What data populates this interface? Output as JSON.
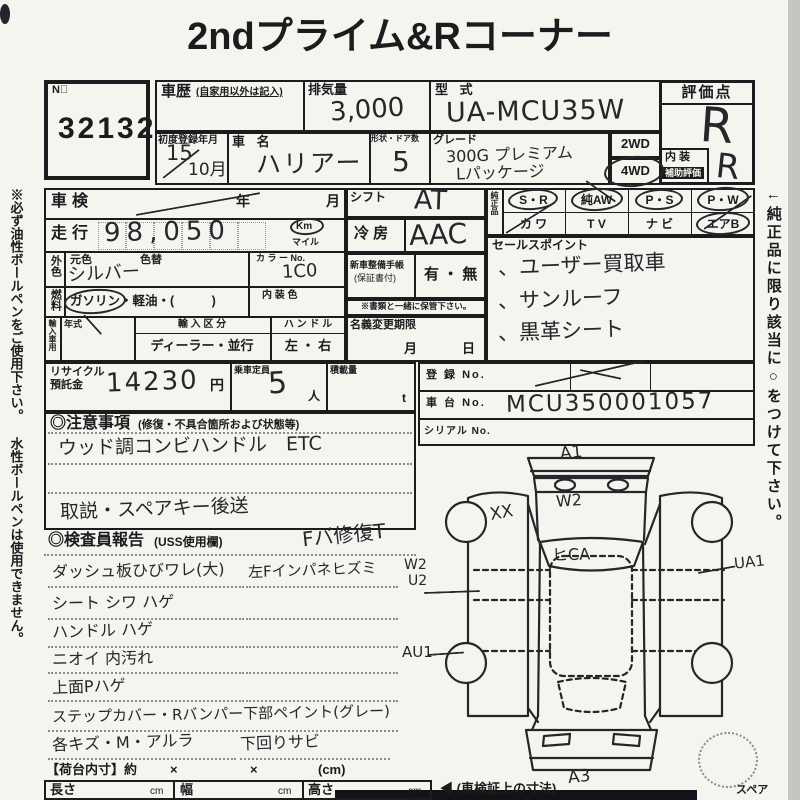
{
  "meta": {
    "paper_color": "#f5f4ef",
    "ink_color": "#1c1c1e",
    "handwriting_color": "#26262b"
  },
  "title": "2ndプライム&Rコーナー",
  "margins": {
    "left_note": "※必ず油性ボールペンをご使用下さい。 水性ボールペンは使用できません。",
    "right_note": "←純正品に限り該当に○をつけて下さい。"
  },
  "lot": {
    "label": "N゚",
    "number": "32132"
  },
  "header": {
    "shareki_label": "車歴",
    "shareki_note": "(自家用以外は記入)",
    "displacement_label": "排気量",
    "displacement": "3,000",
    "model_code_label": "型 式",
    "model_code": "UA-MCU35W",
    "score_label": "評価点",
    "score": "R",
    "interior_label": "内 装",
    "interior_sub": "補助評価",
    "interior_score": "R",
    "first_reg_label": "初度登録年月",
    "first_reg_year": "15",
    "first_reg_month": "10月",
    "name_label": "車 名",
    "name": "ハリアー",
    "doors_label": "形状・ドア数",
    "doors": "5",
    "grade_label": "グレード",
    "grade1": "300G プレミアム",
    "grade2": "Lパッケージ",
    "wd2": "2WD",
    "wd4": "4WD"
  },
  "left": {
    "shaken_label": "車検",
    "year": "年",
    "month": "月",
    "mileage_label": "走行",
    "mileage": "98,050",
    "km": "Km",
    "mile": "マイル",
    "ext_label": "外色",
    "base_label": "元色",
    "repaint_label": "色替",
    "base_color": "シルバー",
    "colorno_label": "カ ラ ー No.",
    "colorno": "1C0",
    "fuel_label": "燃料",
    "fuel_line": "ガソリン・軽油・(　　　)",
    "int_color_label": "内 装 色",
    "import_label": "輸入車用",
    "year_label": "年式",
    "import_kind_label": "輸 入 区 分",
    "import_kind": "ディーラー・並行",
    "handle_label": "ハ ン ド ル",
    "handle": "左 ・ 右",
    "recycle_label1": "リサイクル",
    "recycle_label2": "預託金",
    "recycle": "14230",
    "yen": "円",
    "capacity_label": "乗車定員",
    "capacity": "5",
    "nin": "人",
    "load_label": "積載量",
    "ton": "t"
  },
  "middle": {
    "shift_label": "シフト",
    "shift": "AT",
    "ac_label": "冷 房",
    "ac": "AAC",
    "book_label": "新車整備手帳",
    "book_sub": "(保証書付)",
    "book_opts": "有 ・ 無",
    "keep_note": "※書類と一緒に保管下さい。",
    "transfer_label": "名義変更期限",
    "month": "月",
    "day": "日"
  },
  "equip": {
    "label": "純正品",
    "r1": [
      "S・R",
      "純AW",
      "P・S",
      "P・W"
    ],
    "r2": [
      "カ ワ",
      "T V",
      "ナ ビ",
      "エアB"
    ]
  },
  "sales": {
    "label": "セールスポイント",
    "p1": "、ユーザー買取車",
    "p2": "、サンルーフ",
    "p3": "、黒革シート"
  },
  "reg": {
    "reg_label": "登 録 No.",
    "vin_label": "車 台 No.",
    "vin": "MCU350001057",
    "serial_label": "シリアル No."
  },
  "notes": {
    "title": "◎注意事項",
    "sub": "(修復・不具合箇所および状態等)",
    "l1": "ウッド調コンビハンドル　ETC",
    "l3": "取説・スペアキー後送"
  },
  "report": {
    "title": "◎検査員報告",
    "sub": "(USS使用欄)",
    "scrawl": "Fバ修復T",
    "l1a": "ダッシュ板ひびワレ(大)",
    "l1b": "左Fインパネヒズミ",
    "l2a": "シート シワ ハゲ",
    "l3a": "ハンドル ハゲ",
    "l4a": "ニオイ 内汚れ",
    "l5a": "上面Pハゲ",
    "l6a": "ステップカバー・Rバンパー下部ペイント(グレー)",
    "l7a": "各キズ・M・アルラ",
    "l7b": "下回りサビ"
  },
  "cargo": {
    "label": "【荷台内寸】約",
    "x": "×",
    "unit": "(cm)"
  },
  "dims": {
    "len_label": "長さ",
    "w_label": "幅",
    "h_label": "高さ",
    "cm": "cm",
    "note": "◀ (車検証上の寸法)"
  },
  "diagram": {
    "a1": "A1",
    "w2_hood": "W2",
    "xx": "XX",
    "fca": "ヒCA",
    "w2_margin": "W2",
    "u2_margin": "U2",
    "ua1": "UA1",
    "au1": "AU1",
    "a3": "A3",
    "spare": "スペア"
  }
}
